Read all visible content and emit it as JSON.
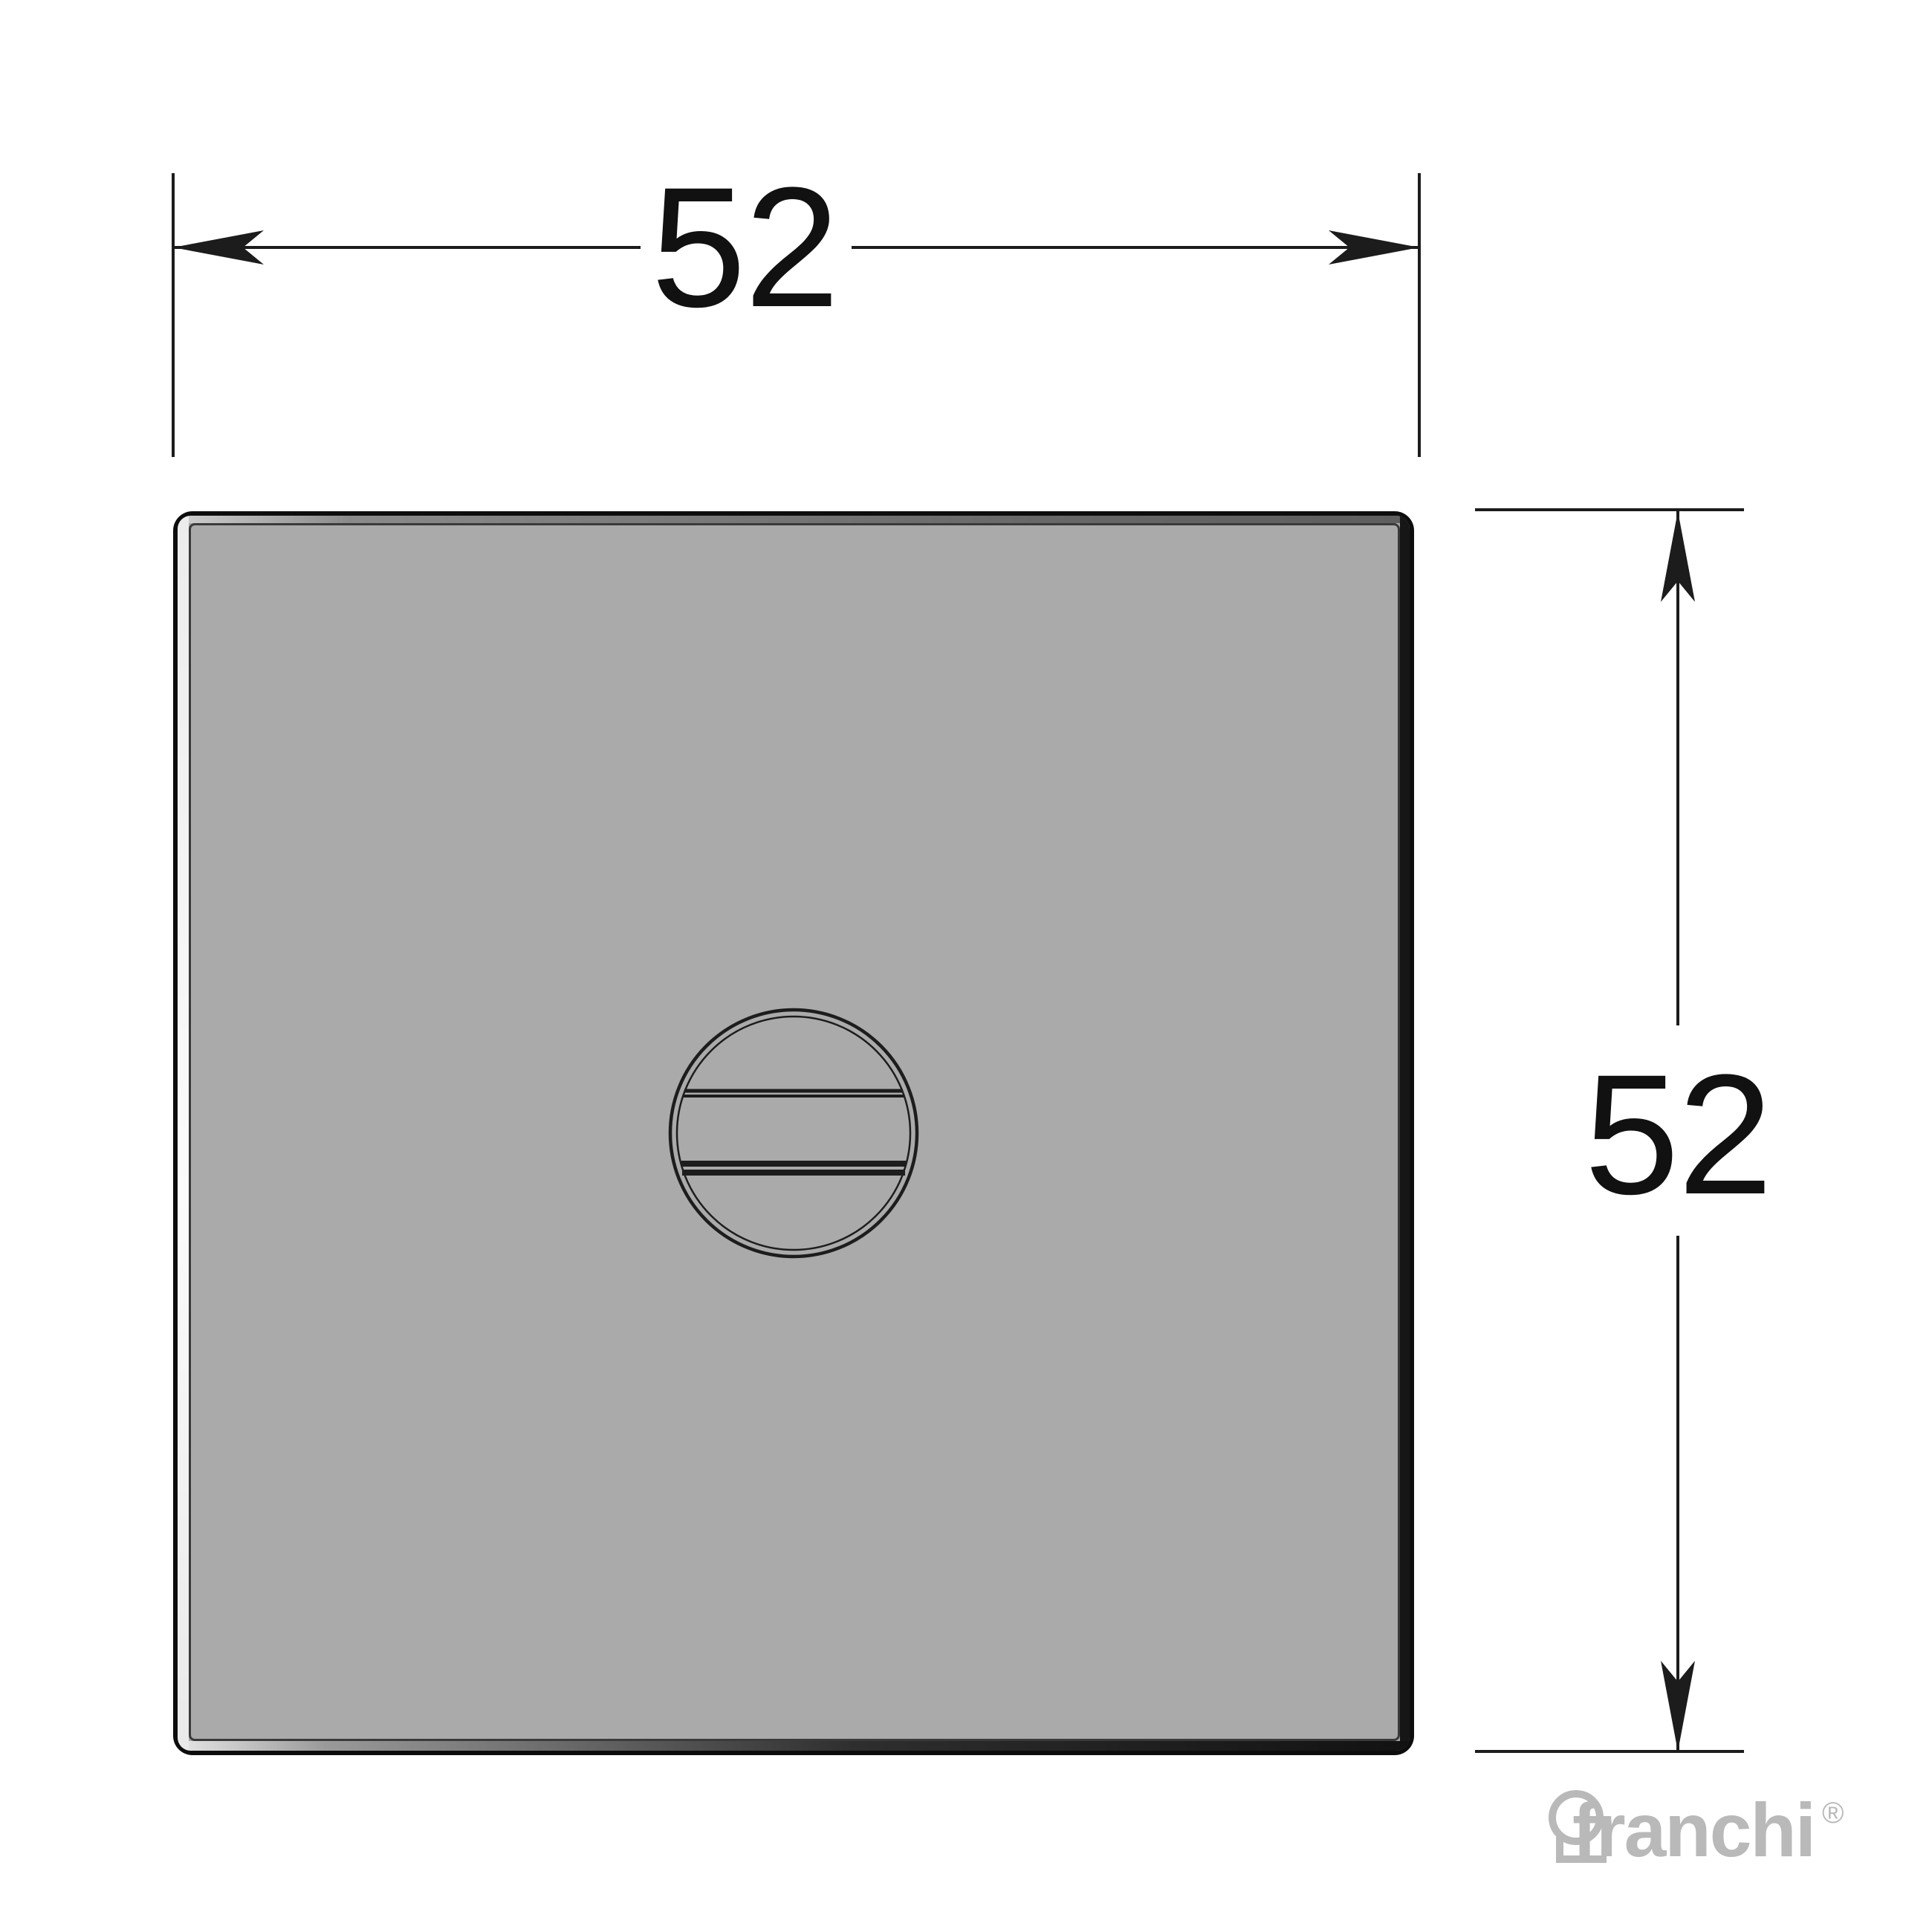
{
  "dimensions": {
    "horizontal": {
      "label": "52"
    },
    "vertical": {
      "label": "52"
    }
  },
  "brand": {
    "name": "franchi",
    "registered_mark": "®"
  },
  "icons": {
    "screw_slot": "slotted-screw-circle-icon",
    "keyhole": "keyhole-icon",
    "arrow_left": "arrow-left-icon",
    "arrow_right": "arrow-right-icon",
    "arrow_up": "arrow-up-icon",
    "arrow_down": "arrow-down-icon"
  },
  "colors": {
    "background": "#ffffff",
    "plate_face": "#aaaaaa",
    "plate_outline": "#0d0d0d",
    "bevel_highlight": "#fbfbfb",
    "bevel_top": "#6e6e6e",
    "bevel_shadow": "#161616",
    "line": "#1c1c1c",
    "dim_text": "#111111",
    "logo_gray": "#b9b9b9"
  }
}
